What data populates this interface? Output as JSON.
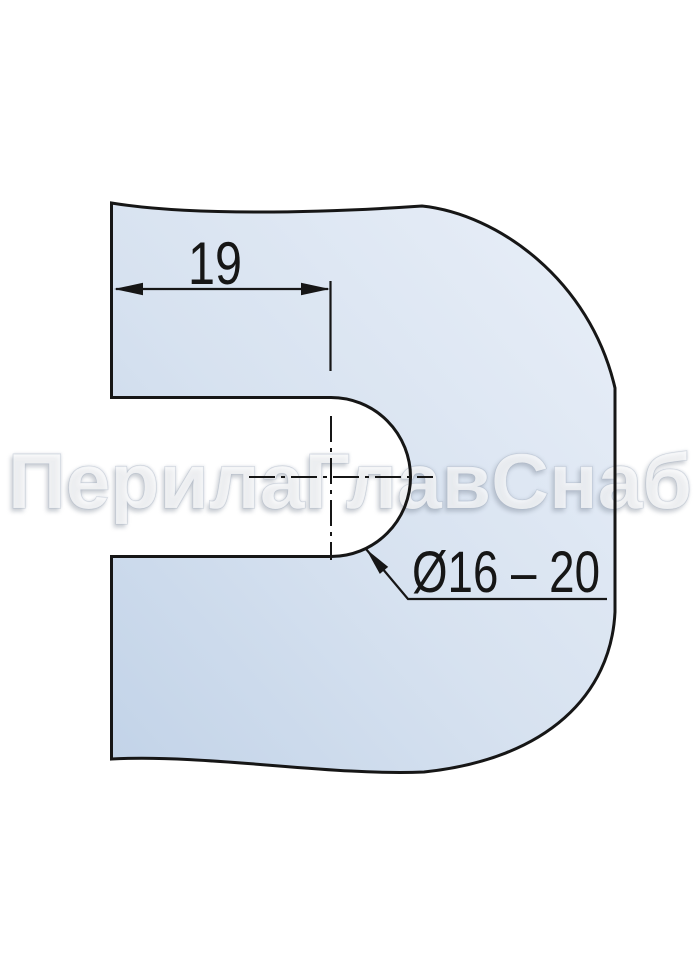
{
  "drawing": {
    "watermark": "ПерилаГлавСнаб",
    "dimensions": [
      {
        "label": "19",
        "type": "linear",
        "meaning": "slot depth to tube center"
      },
      {
        "label": "Ø16 – 20",
        "type": "diameter-range",
        "meaning": "tube slot diameter"
      }
    ],
    "colors": {
      "outline": "#161616",
      "fill_light": "#e9eff8",
      "fill_mid": "#d7e2f0",
      "fill_dark": "#c2d3e8",
      "background": "#ffffff",
      "watermark": "#ffffff"
    }
  }
}
